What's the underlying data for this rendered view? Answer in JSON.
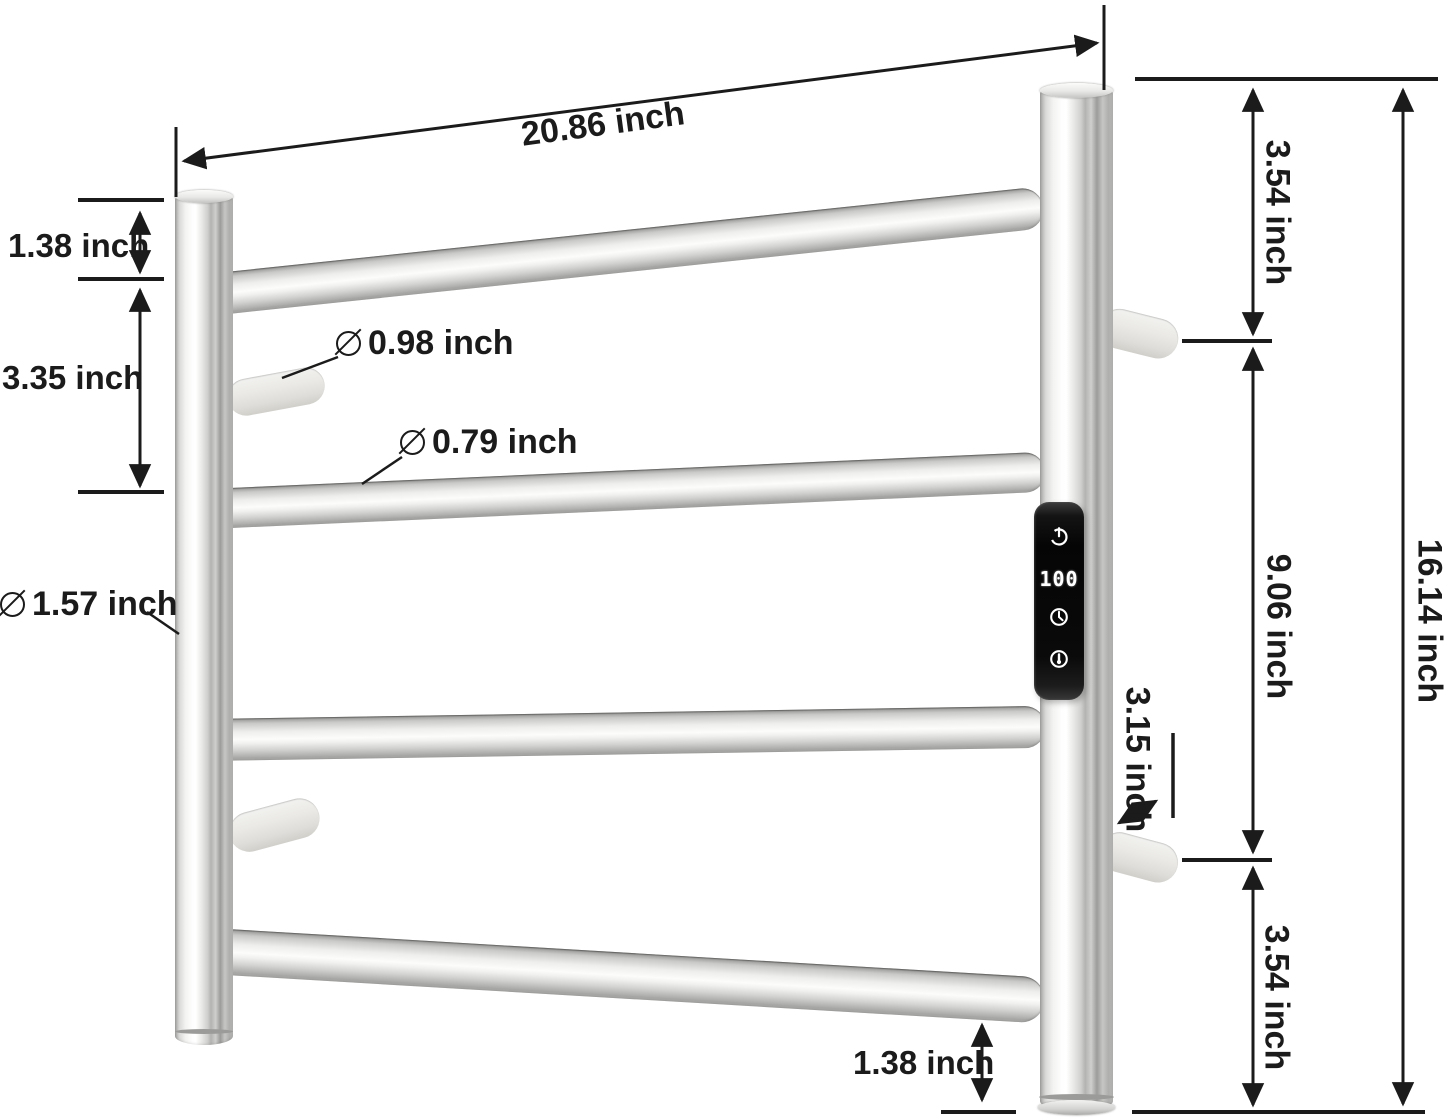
{
  "meta": {
    "type": "product-dimension-diagram",
    "product": "wall-mounted heated towel rack with digital control panel"
  },
  "dimensions": {
    "top_width": "20.86 inch",
    "left_top_offset": "1.38 inch",
    "left_rung_spacing": "3.35 inch",
    "bracket_diameter": "0.98 inch",
    "rung_diameter": "0.79 inch",
    "post_diameter": "1.57 inch",
    "right_top_section": "3.54 inch",
    "right_middle_section": "9.06 inch",
    "right_bottom_section": "3.54 inch",
    "total_height": "16.14 inch",
    "bracket_depth": "3.15 inch",
    "bottom_offset": "1.38 inch"
  },
  "control_panel": {
    "display_value": "100",
    "icons": [
      "power-icon",
      "clock-timer-icon",
      "thermometer-icon"
    ]
  },
  "colors": {
    "annotation": "#1b1b1b",
    "panel_background": "#0a0a0a",
    "panel_foreground": "#ffffff",
    "metal_light": "#f6f6f4",
    "metal_dark": "#a6a6a4",
    "bracket_fill": "#eae9e5"
  }
}
